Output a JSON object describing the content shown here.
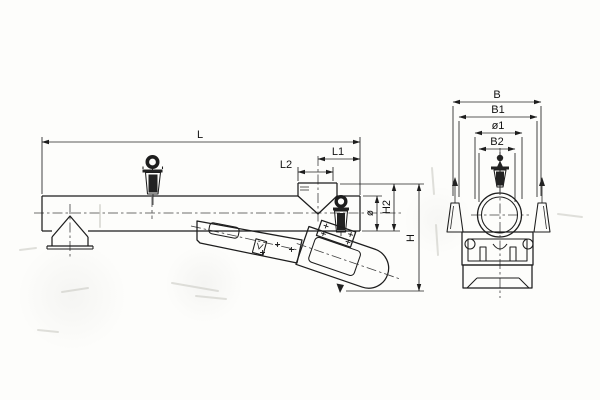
{
  "drawing": {
    "description_colors": {
      "line": "#1d1d1d",
      "centerline": "#3f3f3f",
      "background": "#fdfdfb"
    },
    "side_view": {
      "dims": {
        "L": "L",
        "L1": "L1",
        "L2": "L2",
        "dia": "ø",
        "H2": "H2",
        "H": "H"
      }
    },
    "end_view": {
      "dims": {
        "B": "B",
        "B1": "B1",
        "dia1": "ø1",
        "B2": "B2"
      }
    }
  }
}
